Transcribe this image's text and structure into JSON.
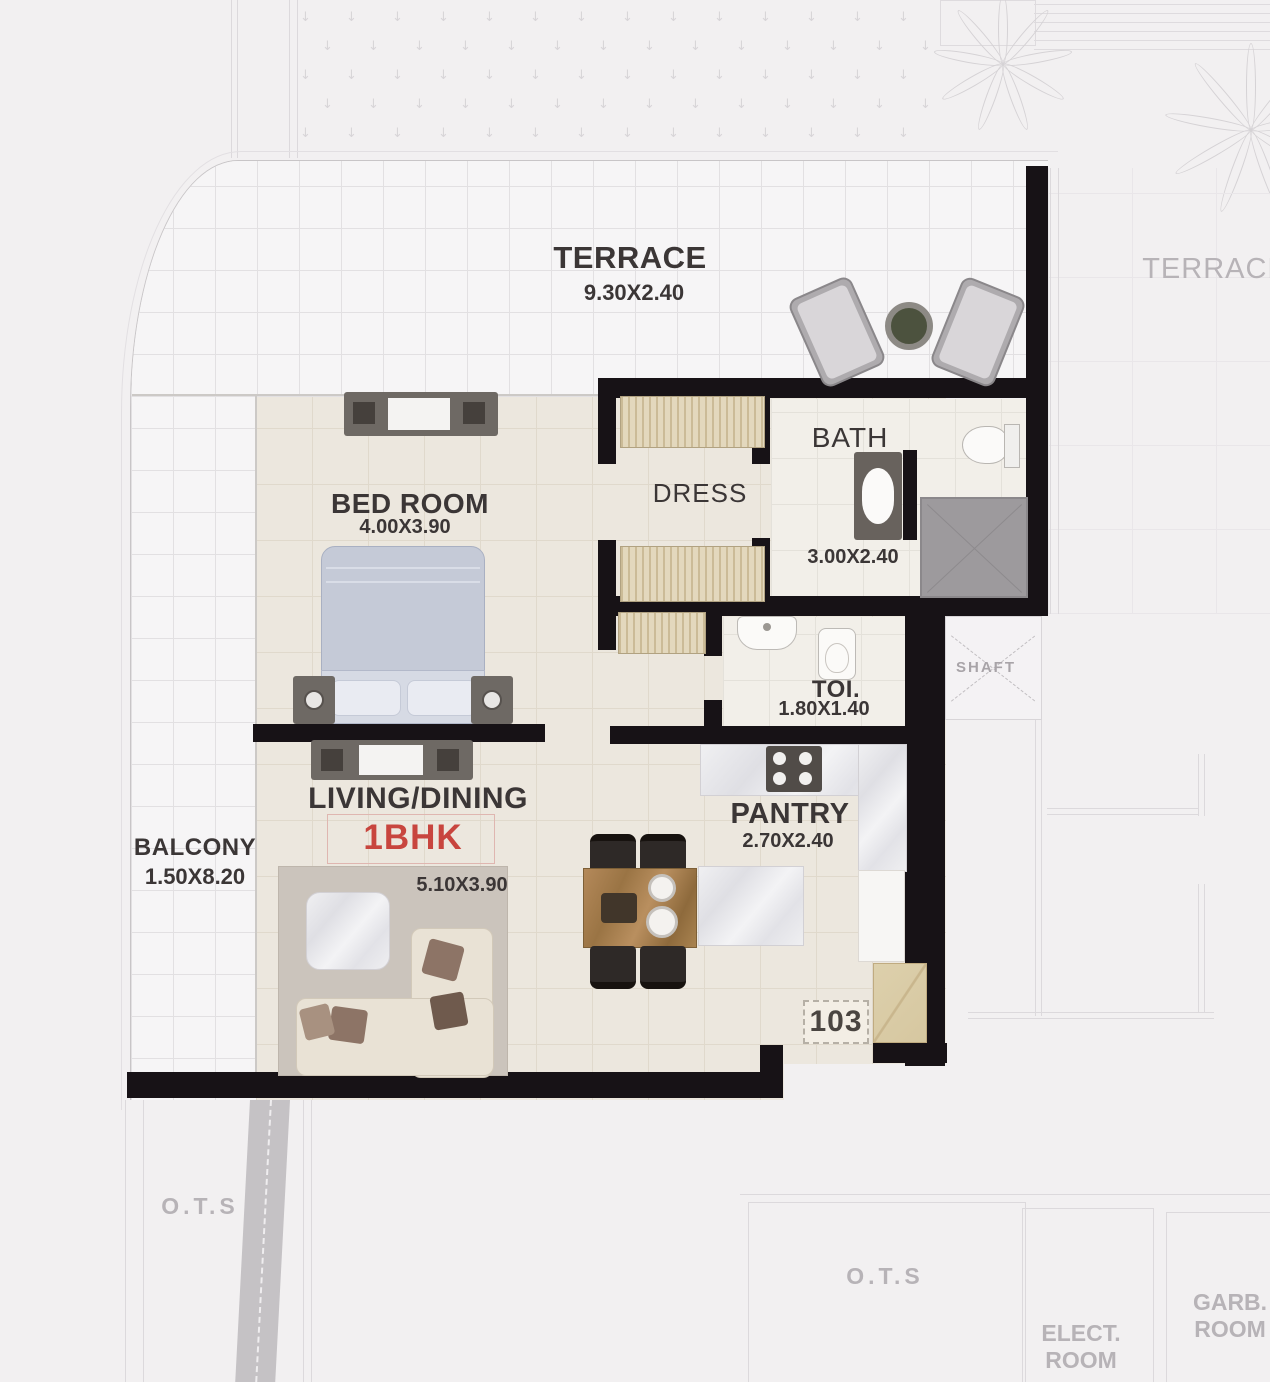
{
  "unit": {
    "number": "103",
    "type": "1BHK"
  },
  "rooms": {
    "terrace": {
      "label": "TERRACE",
      "dims": "9.30X2.40"
    },
    "bedroom": {
      "label": "BED ROOM",
      "dims": "4.00X3.90"
    },
    "dress": {
      "label": "DRESS"
    },
    "bath": {
      "label": "BATH",
      "dims": "3.00X2.40"
    },
    "toilet": {
      "label": "TOI.",
      "dims": "1.80X1.40"
    },
    "pantry": {
      "label": "PANTRY",
      "dims": "2.70X2.40"
    },
    "living": {
      "label": "LIVING/DINING",
      "dims": "5.10X3.90"
    },
    "balcony": {
      "label": "BALCONY",
      "dims": "1.50X8.20"
    },
    "shaft": {
      "label": "SHAFT"
    }
  },
  "adjacent": {
    "terrace_right": "TERRACE",
    "ots_left": "O.T.S",
    "ots_right": "O.T.S",
    "elect_room": [
      "ELECT.",
      "ROOM"
    ],
    "garb_room": [
      "GARB.",
      "ROOM"
    ]
  },
  "colors": {
    "wall": "#171216",
    "unit_type_accent": "#c8453e",
    "floor_beige": "#ece7de",
    "tile_white": "#f6f5f6",
    "wardrobe_tan": "#dfd3b7",
    "faint_text": "#b7b3b7",
    "label_text": "#3b3636"
  }
}
